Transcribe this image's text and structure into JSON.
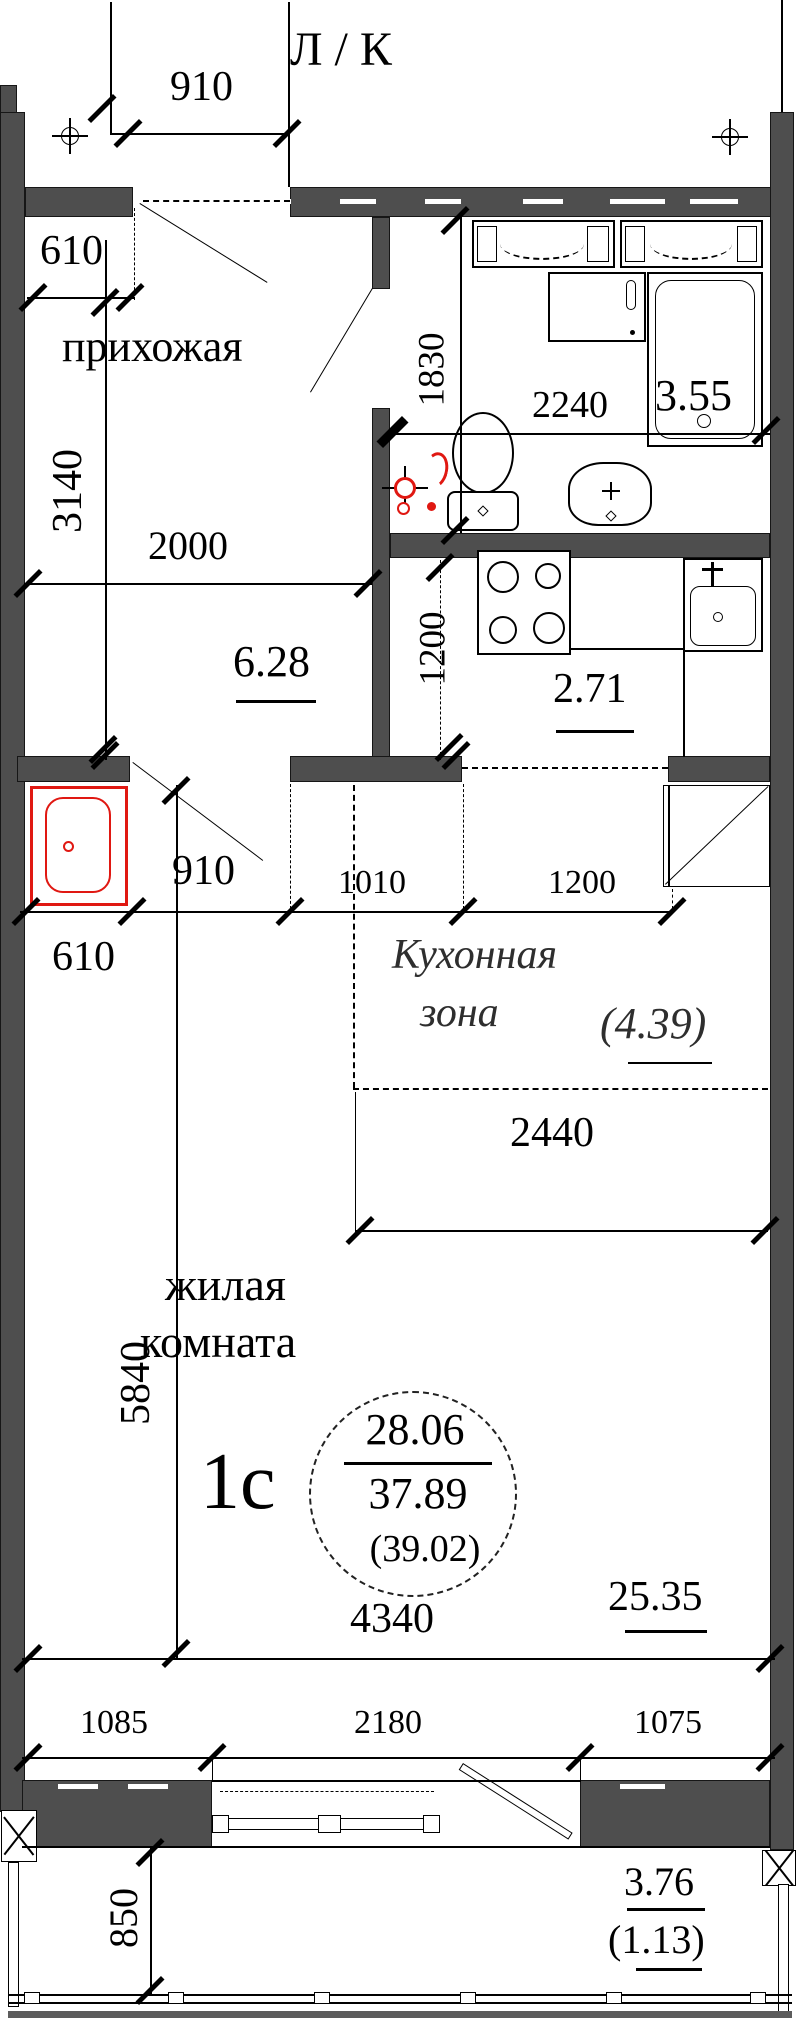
{
  "plan": {
    "header": "Л / К",
    "apartment": {
      "type_label": "1с",
      "living_area": "28.06",
      "total_area": "37.89",
      "total_area_with_balcony": "(39.02)"
    },
    "rooms": {
      "hallway": {
        "name": "прихожая",
        "area": "6.28"
      },
      "bathroom": {
        "area": "3.55"
      },
      "kitchen": {
        "area": "2.71"
      },
      "kitchen_zone": {
        "name_line1": "Кухонная",
        "name_line2": "зона",
        "area": "(4.39)"
      },
      "living_room": {
        "name_line1": "жилая",
        "name_line2": "комната",
        "area": "25.35"
      },
      "balcony": {
        "area": "3.76",
        "area_reduced": "(1.13)"
      }
    },
    "dimensions": {
      "top_door": "910",
      "top_left": "610",
      "hall_height": "3140",
      "hall_width": "2000",
      "bath_depth": "1830",
      "bath_width": "2240",
      "kitchen_depth": "1200",
      "mid_610": "610",
      "mid_910": "910",
      "mid_1010": "1010",
      "mid_1200": "1200",
      "zone_width": "2440",
      "room_height": "5840",
      "room_width": "4340",
      "bottom_left": "1085",
      "bottom_center": "2180",
      "bottom_right": "1075",
      "balcony_depth": "850"
    },
    "colors": {
      "wall": "#4e4e4e",
      "line": "#000000",
      "accent_red": "#e01812"
    }
  }
}
